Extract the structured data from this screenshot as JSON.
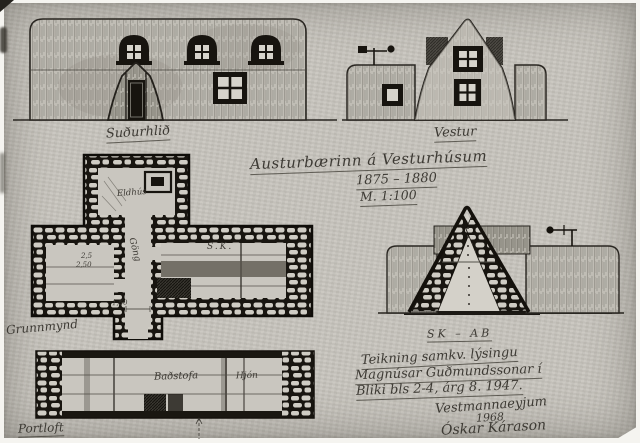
{
  "colors": {
    "paper": "#c7c4bd",
    "ink": "#17140f",
    "pencil": "#4b4842",
    "frame": "#f5f4f0"
  },
  "title_block": {
    "title": "Austurbærinn á Vesturhúsum",
    "dates": "1875 – 1880",
    "scale": "M. 1:100"
  },
  "elevations": {
    "south": {
      "caption": "Suðurhlið"
    },
    "west": {
      "caption": "Vestur"
    }
  },
  "ground_plan": {
    "caption": "Grunnmynd",
    "labels": {
      "kitchen": "Eldhús",
      "passage": "Göng",
      "main_room": "S.K.",
      "left_dims": [
        "2,5",
        "2,50"
      ],
      "passage_dim": "1,50"
    }
  },
  "section": {
    "caption": "SK – AB"
  },
  "loft_plan": {
    "caption": "Portloft",
    "labels": {
      "badstofa": "Baðstofa",
      "hjon": "Hjón"
    }
  },
  "attribution": {
    "line1": "Teikning samkv. lýsingu",
    "line2": "Magnúsar Guðmundssonar í",
    "line3": "Bliki bls 2-4, árg 8. 1947.",
    "place": "Vestmannaeyjum",
    "year": "1968",
    "signature": "Óskar Kárason"
  }
}
